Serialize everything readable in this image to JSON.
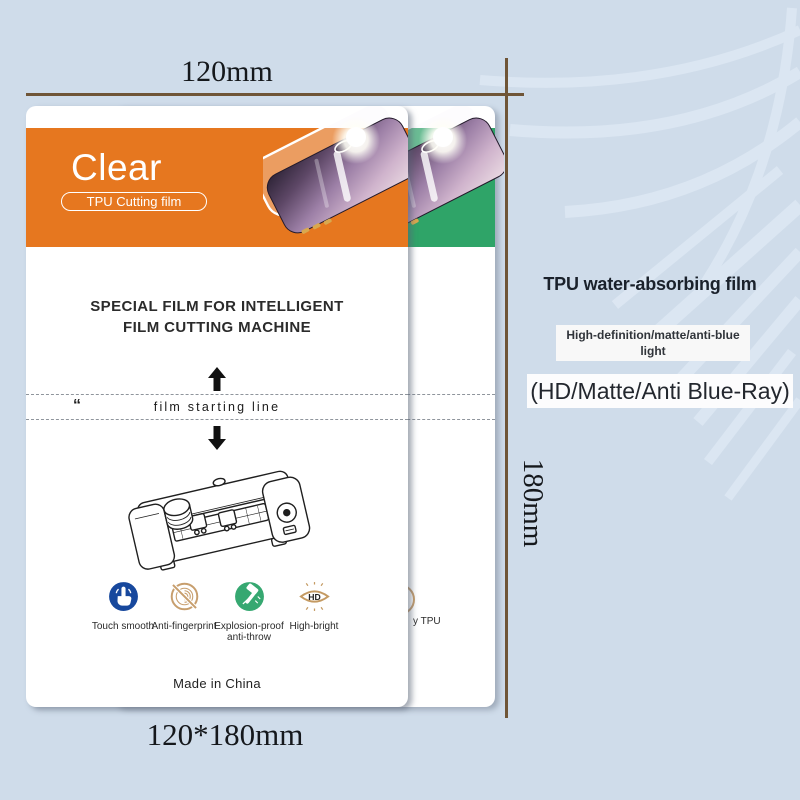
{
  "dimensions": {
    "width_label": "120mm",
    "height_label": "180mm",
    "size_label": "120*180mm"
  },
  "front_card": {
    "header": {
      "title": "Clear",
      "badge": "TPU Cutting film"
    },
    "heading_line1": "SPECIAL FILM FOR INTELLIGENT",
    "heading_line2": "FILM CUTTING MACHINE",
    "quote_mark": "“",
    "film_line_label": "film starting line",
    "features": [
      {
        "icon": "touch-icon",
        "label": "Touch smooth"
      },
      {
        "icon": "anti-fingerprint-icon",
        "label": "Anti-fingerprint"
      },
      {
        "icon": "explosion-proof-icon",
        "label": "Explosion-proof",
        "label2": "anti-throw"
      },
      {
        "icon": "high-bright-icon",
        "label": "High-bright",
        "hd_text": "HD"
      }
    ],
    "made_in": "Made in China"
  },
  "back_card": {
    "partial_label": "y TPU"
  },
  "right_panel": {
    "title": "TPU water-absorbing film",
    "tag_line1": "High-definition/matte/anti-blue",
    "tag_line2": "light",
    "subtitle": "(HD/Matte/Anti Blue-Ray)"
  },
  "colors": {
    "background": "#cfdcea",
    "dimension_line": "#6f5537",
    "front_header_orange": "#e6771f",
    "back_header_green": "#2fa468",
    "icon_blue": "#17489d",
    "icon_tan": "#c79e6d",
    "icon_green": "#36a871",
    "icon_gold": "#c49a62",
    "phone_button_gold": "#d9a84e"
  }
}
